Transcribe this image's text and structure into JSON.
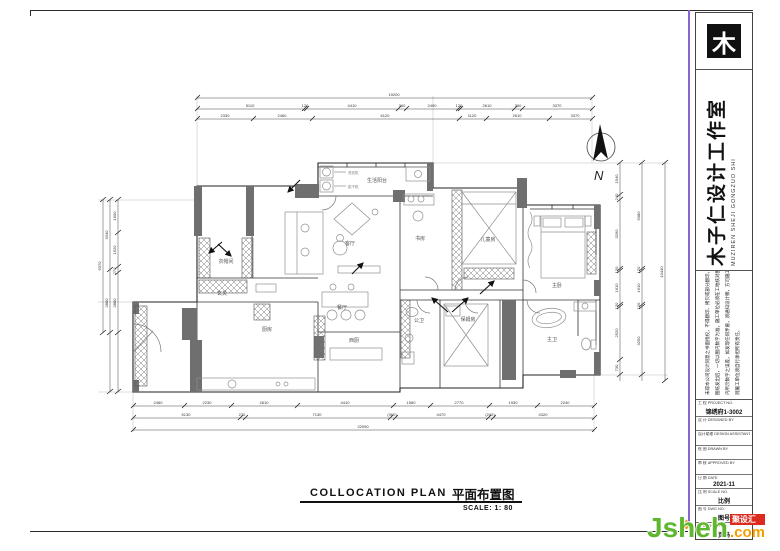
{
  "title_block": {
    "logo_glyph": "木",
    "company_cn": "木子仁设计工作室",
    "company_en": "MUZIREN SHEJI GONGZUO SHI",
    "disclaimer": [
      "未得本公司设计同意之书面授权，不得翻印、拷贝或部分翻印，切勿以此",
      "图纸发出后，一切以图内数字为准，施工单位必须在工地核对图纸",
      "内所示数字之误差，如发现任何矛盾，须通知设计师，方可施工，否",
      "则施工单位须自行承担所有责任。"
    ],
    "rows": [
      {
        "l": "工 程 PROJECT NO.",
        "v": "锦绣府1-3002"
      },
      {
        "l": "设 计 DESIGNED BY",
        "v": ""
      },
      {
        "l": "设计助理 DESIGN ASSISTANT",
        "v": ""
      },
      {
        "l": "绘 图 DRAWN BY",
        "v": ""
      },
      {
        "l": "审 核 APPROVED BY",
        "v": ""
      },
      {
        "l": "日 期 DATE",
        "v": "2021-11"
      },
      {
        "l": "比 例 SCALE NO.",
        "v": "比例"
      },
      {
        "l": "图 号 DWG NO.",
        "v": "图号"
      },
      {
        "l": "页 码 SHEET NO.",
        "v": "页码"
      }
    ]
  },
  "plan": {
    "north": "N",
    "rooms": {
      "balcony": "生活阳台",
      "cloak": "衣帽间",
      "foyer": "玄关",
      "living": "客厅",
      "dining": "餐厅",
      "kitchen": "厨房",
      "westkitchen": "西厨",
      "study": "书房",
      "kids": "儿童房",
      "master": "主卧",
      "guestbath": "公卫",
      "nanny": "保姆房",
      "masterbath": "主卫",
      "washer": "洗衣机",
      "dryer": "烘干机"
    },
    "dims": {
      "t1": [
        "19200"
      ],
      "t2": [
        "5110",
        "120",
        "4410",
        "360",
        "2490",
        "120",
        "2610",
        "360",
        "3370"
      ],
      "t3": [
        "2330",
        "2460",
        "6120",
        "1120",
        "2610",
        "3370"
      ],
      "b1": [
        "2460",
        "2230",
        "2610",
        "4410",
        "1560",
        "2770",
        "1930",
        "2240"
      ],
      "b2": [
        "5130",
        "270",
        "7130",
        "(360)",
        "4470",
        "(240)",
        "4320"
      ],
      "b3": [
        "22090"
      ],
      "l1": [
        "1600",
        "1620",
        "270",
        "2880"
      ],
      "l2": [
        "3340",
        "2880"
      ],
      "l3": [
        "6370"
      ],
      "r1": [
        "1540",
        "240",
        "3290",
        "120",
        "1610",
        "120",
        "2520",
        "730"
      ],
      "r2": [
        "5080",
        "120",
        "1610",
        "120",
        "3250"
      ],
      "r3": [
        "10440"
      ]
    }
  },
  "footer": {
    "title_en": "COLLOCATION PLAN",
    "title_cn": "平面布置图",
    "scale": "SCALE: 1: 80"
  },
  "watermark": {
    "brand": "Jsheh",
    "badge": "聚设汇",
    "tld": ".com"
  },
  "colors": {
    "accent_purple": "#8766d2",
    "wm_green": "#5fb72e",
    "wm_orange": "#f59d00",
    "wm_red": "#dc2b1e",
    "wall_gray": "#6f6f6f"
  }
}
